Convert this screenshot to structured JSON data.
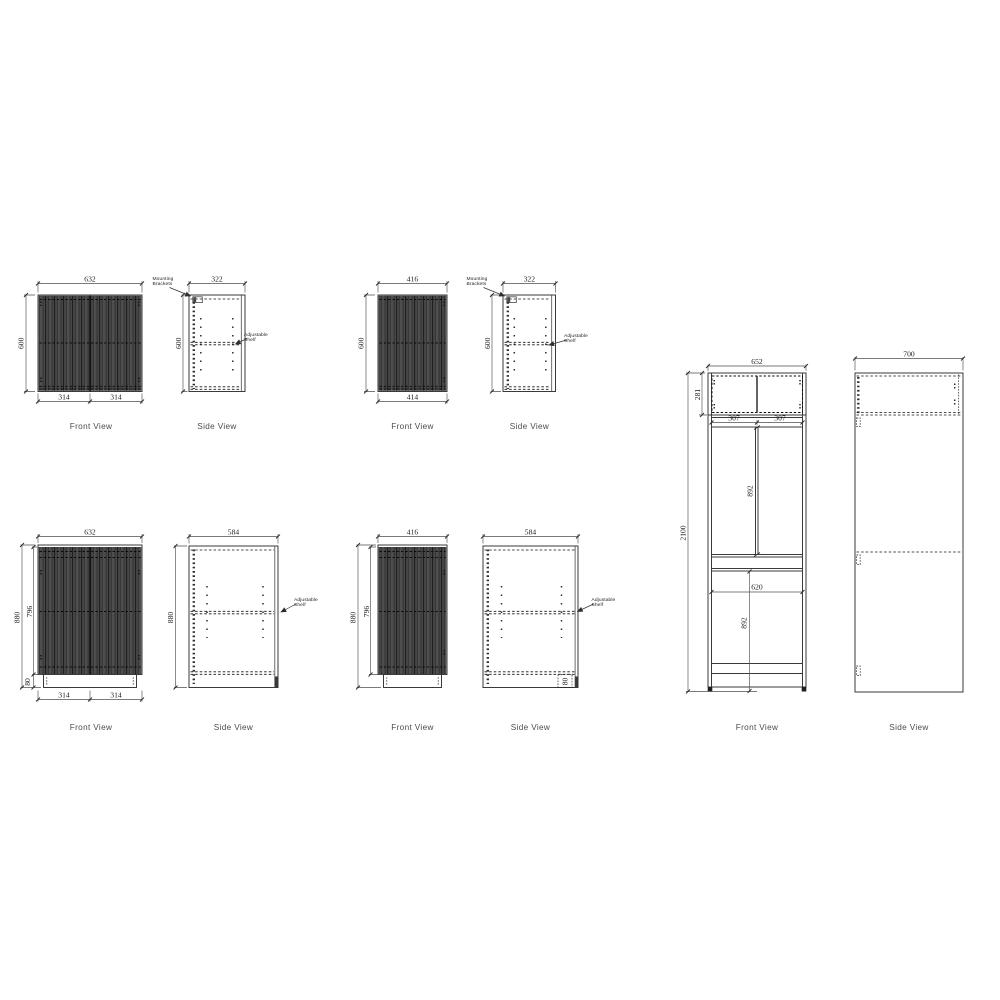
{
  "page": {
    "background": "#ffffff",
    "line_color": "#3a3a3a",
    "door_fill": "#474747"
  },
  "sets": {
    "wall_632": {
      "front": {
        "label": "Front View",
        "dim_top": "632",
        "dim_left": "600",
        "dim_bottom_left": "314",
        "dim_bottom_right": "314"
      },
      "side": {
        "label": "Side View",
        "dim_top": "322",
        "dim_left": "600",
        "annotation_mounting": "Mounting Brackets",
        "annotation_shelf": "Adjustable Shelf"
      }
    },
    "wall_416": {
      "front": {
        "label": "Front View",
        "dim_top": "416",
        "dim_left": "600",
        "dim_bottom": "414"
      },
      "side": {
        "label": "Side View",
        "dim_top": "322",
        "dim_left": "600",
        "annotation_mounting": "Mounting Brackets",
        "annotation_shelf": "Adjustable Shelf"
      }
    },
    "base_632": {
      "front": {
        "label": "Front View",
        "dim_top": "632",
        "dim_left_outer": "880",
        "dim_left_inner": "796",
        "dim_kick": "80",
        "dim_bottom_left": "314",
        "dim_bottom_right": "314"
      },
      "side": {
        "label": "Side View",
        "dim_top": "584",
        "dim_left": "880",
        "annotation_shelf": "Adjustable Shelf"
      }
    },
    "base_416": {
      "front": {
        "label": "Front View",
        "dim_top": "416",
        "dim_left_outer": "880",
        "dim_left_inner": "796"
      },
      "side": {
        "label": "Side View",
        "dim_top": "584",
        "dim_kick": "80",
        "annotation_shelf": "Adjustable Shelf"
      }
    },
    "tall_unit": {
      "front": {
        "label": "Front View",
        "dim_top": "652",
        "dim_left": "2100",
        "dim_top_section": "281",
        "dim_door_left": "307",
        "dim_door_right": "307",
        "dim_upper_section": "892",
        "dim_mid_width": "620",
        "dim_lower_section": "892"
      },
      "side": {
        "label": "Side View",
        "dim_top": "700"
      }
    }
  }
}
